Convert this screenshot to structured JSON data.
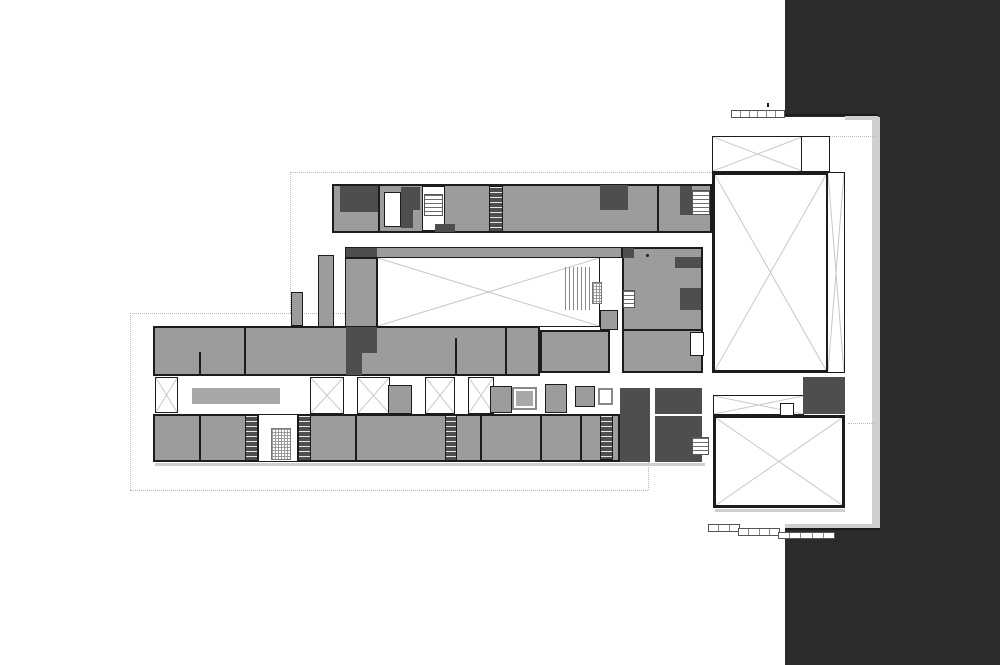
{
  "document": {
    "type": "architectural-floor-plan",
    "visible_text": [],
    "notes": "monochrome building floor plan; no text labels visible"
  },
  "plan": {
    "colors": {
      "background": "#ffffff",
      "dark-mass": "#2b2b2b",
      "room-fill": "#9c9c9c",
      "core-fill": "#4e4e4e",
      "wall": "#1c1c1c",
      "xline": "#c8c8c8",
      "dotted": "#b9b9b9",
      "shadow": "#cfcfcf",
      "furniture": "#a8a8a8",
      "white-fill": "#ffffff",
      "window-border": "#8a8a8a"
    },
    "elements": [
      {
        "n": "site-dark-mass-top",
        "t": "dark",
        "x": 785,
        "y": 0,
        "w": 215,
        "h": 117
      },
      {
        "n": "site-dark-mass-right",
        "t": "dark",
        "x": 880,
        "y": 117,
        "w": 120,
        "h": 413
      },
      {
        "n": "site-dark-mass-bottom",
        "t": "dark",
        "x": 785,
        "y": 530,
        "w": 215,
        "h": 135
      },
      {
        "n": "dark-edge-shadow-vertical",
        "t": "shadow",
        "x": 872,
        "y": 117,
        "w": 8,
        "h": 407
      },
      {
        "n": "dark-edge-shadow-horizontal",
        "t": "shadow",
        "x": 785,
        "y": 524,
        "w": 95,
        "h": 6
      },
      {
        "n": "dark-edge-line-top",
        "t": "wall",
        "x": 785,
        "y": 114,
        "w": 93,
        "h": 2
      },
      {
        "n": "dark-edge-canopy",
        "t": "shadow",
        "x": 845,
        "y": 116,
        "w": 33,
        "h": 4
      },
      {
        "n": "dark-edge-line-bottom",
        "t": "wall",
        "x": 785,
        "y": 528,
        "w": 95,
        "h": 2
      },
      {
        "n": "site-boundary-top",
        "t": "dotted-h",
        "x": 290,
        "y": 172,
        "w": 422,
        "h": 0
      },
      {
        "n": "site-boundary-left-upper",
        "t": "dotted-v",
        "x": 290,
        "y": 172,
        "w": 0,
        "h": 141
      },
      {
        "n": "site-boundary-step",
        "t": "dotted-h",
        "x": 130,
        "y": 313,
        "w": 215,
        "h": 0
      },
      {
        "n": "site-boundary-left-lower",
        "t": "dotted-v",
        "x": 130,
        "y": 313,
        "w": 0,
        "h": 177
      },
      {
        "n": "site-boundary-bottom",
        "t": "dotted-h",
        "x": 130,
        "y": 490,
        "w": 518,
        "h": 0
      },
      {
        "n": "site-boundary-right-stub",
        "t": "dotted-v",
        "x": 648,
        "y": 462,
        "w": 0,
        "h": 28
      },
      {
        "n": "site-boundary-annex",
        "t": "dotted-h",
        "x": 830,
        "y": 136,
        "w": 47,
        "h": 0
      },
      {
        "n": "site-boundary-annex-lower",
        "t": "dotted-h",
        "x": 848,
        "y": 423,
        "w": 28,
        "h": 0
      },
      {
        "n": "lower-wing-upper-rooms",
        "t": "band",
        "x": 153,
        "y": 326,
        "w": 387,
        "h": 50
      },
      {
        "n": "lower-wing-lower-rooms",
        "t": "band",
        "x": 153,
        "y": 414,
        "w": 467,
        "h": 48
      },
      {
        "n": "lower-wing-bottom-shadow",
        "t": "shadow",
        "x": 155,
        "y": 463,
        "w": 550,
        "h": 3
      },
      {
        "n": "courtyard-gallery-top",
        "t": "room",
        "x": 345,
        "y": 247,
        "w": 277,
        "h": 11
      },
      {
        "n": "gallery-core-cells",
        "t": "core",
        "x": 346,
        "y": 248,
        "w": 31,
        "h": 9
      },
      {
        "n": "courtyard-gallery-left",
        "t": "room",
        "x": 345,
        "y": 258,
        "w": 32,
        "h": 69
      },
      {
        "n": "courtyard-void",
        "t": "void-x",
        "x": 377,
        "y": 257,
        "w": 223,
        "h": 70
      },
      {
        "n": "courtyard-stair",
        "t": "stair-v",
        "x": 565,
        "y": 267,
        "w": 28,
        "h": 43
      },
      {
        "n": "courtyard-elevator",
        "t": "stair-fine",
        "x": 592,
        "y": 282,
        "w": 10,
        "h": 22
      },
      {
        "n": "courtyard-east-walk",
        "t": "room",
        "x": 600,
        "y": 310,
        "w": 18,
        "h": 20
      },
      {
        "n": "west-link-corridor",
        "t": "room",
        "x": 318,
        "y": 255,
        "w": 16,
        "h": 72
      },
      {
        "n": "west-link-stub",
        "t": "room",
        "x": 291,
        "y": 292,
        "w": 12,
        "h": 34
      },
      {
        "n": "top-wing",
        "t": "band",
        "x": 332,
        "y": 184,
        "w": 380,
        "h": 49
      },
      {
        "n": "top-wing-core-a",
        "t": "core",
        "x": 340,
        "y": 186,
        "w": 38,
        "h": 26
      },
      {
        "n": "top-wing-room-divider-a",
        "t": "wall",
        "x": 378,
        "y": 184,
        "w": 2,
        "h": 49
      },
      {
        "n": "top-wing-white-room",
        "t": "white-room",
        "x": 384,
        "y": 192,
        "w": 17,
        "h": 35
      },
      {
        "n": "top-wing-core-b",
        "t": "core",
        "x": 401,
        "y": 187,
        "w": 19,
        "h": 23
      },
      {
        "n": "top-wing-core-b2",
        "t": "core",
        "x": 401,
        "y": 210,
        "w": 12,
        "h": 18
      },
      {
        "n": "top-wing-stair-bay",
        "t": "white-room",
        "x": 422,
        "y": 186,
        "w": 23,
        "h": 45
      },
      {
        "n": "top-wing-stair",
        "t": "stair-h",
        "x": 424,
        "y": 194,
        "w": 19,
        "h": 22
      },
      {
        "n": "top-wing-core-c",
        "t": "core",
        "x": 435,
        "y": 224,
        "w": 20,
        "h": 8
      },
      {
        "n": "top-wing-stair-core",
        "t": "core-stair",
        "x": 489,
        "y": 186,
        "w": 14,
        "h": 46
      },
      {
        "n": "top-wing-core-d",
        "t": "core",
        "x": 600,
        "y": 185,
        "w": 28,
        "h": 25
      },
      {
        "n": "top-wing-room-divider-b",
        "t": "wall",
        "x": 657,
        "y": 184,
        "w": 2,
        "h": 49
      },
      {
        "n": "top-wing-core-e",
        "t": "core",
        "x": 680,
        "y": 186,
        "w": 12,
        "h": 29
      },
      {
        "n": "top-wing-stair-east",
        "t": "stair-h",
        "x": 692,
        "y": 190,
        "w": 18,
        "h": 25
      },
      {
        "n": "mid-east-block",
        "t": "band",
        "x": 622,
        "y": 247,
        "w": 81,
        "h": 126
      },
      {
        "n": "mid-east-core-a",
        "t": "core",
        "x": 623,
        "y": 248,
        "w": 11,
        "h": 10
      },
      {
        "n": "mid-east-core-b",
        "t": "core",
        "x": 675,
        "y": 257,
        "w": 26,
        "h": 11
      },
      {
        "n": "mid-east-core-wedges",
        "t": "core",
        "x": 680,
        "y": 288,
        "w": 21,
        "h": 22
      },
      {
        "n": "mid-east-stair",
        "t": "stair-h",
        "x": 623,
        "y": 290,
        "w": 12,
        "h": 18
      },
      {
        "n": "mid-east-wall",
        "t": "wall",
        "x": 622,
        "y": 329,
        "w": 81,
        "h": 2
      },
      {
        "n": "mid-east-white-cells",
        "t": "white-room",
        "x": 690,
        "y": 332,
        "w": 14,
        "h": 24
      },
      {
        "n": "mid-east-column-dot",
        "t": "dot",
        "x": 646,
        "y": 254,
        "w": 3,
        "h": 3
      },
      {
        "n": "mid-center-block",
        "t": "band",
        "x": 540,
        "y": 330,
        "w": 70,
        "h": 43
      },
      {
        "n": "upper-rooms-divider-a",
        "t": "wall",
        "x": 199,
        "y": 352,
        "w": 2,
        "h": 24
      },
      {
        "n": "upper-rooms-divider-b",
        "t": "wall",
        "x": 244,
        "y": 326,
        "w": 2,
        "h": 50
      },
      {
        "n": "upper-rooms-divider-c",
        "t": "wall",
        "x": 455,
        "y": 338,
        "w": 2,
        "h": 38
      },
      {
        "n": "upper-rooms-divider-d",
        "t": "wall",
        "x": 505,
        "y": 326,
        "w": 2,
        "h": 50
      },
      {
        "n": "core-cells-west-gallery",
        "t": "core",
        "x": 346,
        "y": 327,
        "w": 31,
        "h": 26
      },
      {
        "n": "core-cells-west-gallery-2",
        "t": "core",
        "x": 346,
        "y": 353,
        "w": 16,
        "h": 22
      },
      {
        "n": "lightwell-bay-1",
        "t": "void-x",
        "x": 155,
        "y": 377,
        "w": 23,
        "h": 36
      },
      {
        "n": "corridor-furniture",
        "t": "furniture",
        "x": 192,
        "y": 388,
        "w": 88,
        "h": 16
      },
      {
        "n": "lightwell-bay-2",
        "t": "void-x",
        "x": 310,
        "y": 377,
        "w": 34,
        "h": 37
      },
      {
        "n": "lightwell-bay-3",
        "t": "void-x",
        "x": 357,
        "y": 377,
        "w": 33,
        "h": 37
      },
      {
        "n": "lightwell-block-1",
        "t": "room",
        "x": 388,
        "y": 385,
        "w": 24,
        "h": 29
      },
      {
        "n": "lightwell-bay-4",
        "t": "void-x",
        "x": 425,
        "y": 377,
        "w": 30,
        "h": 37
      },
      {
        "n": "lightwell-bay-5",
        "t": "void-x",
        "x": 468,
        "y": 377,
        "w": 26,
        "h": 37
      },
      {
        "n": "lightwell-block-2",
        "t": "room",
        "x": 490,
        "y": 386,
        "w": 22,
        "h": 27
      },
      {
        "n": "corridor-window-box",
        "t": "window-box",
        "x": 512,
        "y": 387,
        "w": 25,
        "h": 23
      },
      {
        "n": "corridor-window-inset",
        "t": "furniture",
        "x": 516,
        "y": 391,
        "w": 17,
        "h": 15
      },
      {
        "n": "lightwell-block-3",
        "t": "room",
        "x": 545,
        "y": 384,
        "w": 22,
        "h": 29
      },
      {
        "n": "lightwell-block-4",
        "t": "room",
        "x": 575,
        "y": 386,
        "w": 20,
        "h": 21
      },
      {
        "n": "corridor-white-box",
        "t": "window-box",
        "x": 598,
        "y": 388,
        "w": 15,
        "h": 17
      },
      {
        "n": "stair-core-a",
        "t": "core-stair",
        "x": 245,
        "y": 415,
        "w": 13,
        "h": 46
      },
      {
        "n": "central-stair-bay",
        "t": "white-room",
        "x": 258,
        "y": 414,
        "w": 40,
        "h": 48
      },
      {
        "n": "central-stair",
        "t": "stair-fine",
        "x": 271,
        "y": 428,
        "w": 20,
        "h": 32
      },
      {
        "n": "stair-core-b",
        "t": "core-stair",
        "x": 298,
        "y": 415,
        "w": 13,
        "h": 46
      },
      {
        "n": "stair-core-c",
        "t": "core-stair",
        "x": 445,
        "y": 415,
        "w": 12,
        "h": 46
      },
      {
        "n": "stair-core-d",
        "t": "core-stair",
        "x": 600,
        "y": 415,
        "w": 13,
        "h": 45
      },
      {
        "n": "lower-rooms-divider-a",
        "t": "wall",
        "x": 199,
        "y": 414,
        "w": 2,
        "h": 48
      },
      {
        "n": "lower-rooms-divider-b",
        "t": "wall",
        "x": 355,
        "y": 414,
        "w": 2,
        "h": 48
      },
      {
        "n": "lower-rooms-divider-c",
        "t": "wall",
        "x": 480,
        "y": 414,
        "w": 2,
        "h": 48
      },
      {
        "n": "lower-rooms-divider-d",
        "t": "wall",
        "x": 540,
        "y": 414,
        "w": 2,
        "h": 48
      },
      {
        "n": "lower-rooms-divider-e",
        "t": "wall",
        "x": 580,
        "y": 414,
        "w": 2,
        "h": 48
      },
      {
        "n": "entry-door-line",
        "t": "wall",
        "x": 168,
        "y": 460,
        "w": 37,
        "h": 2
      },
      {
        "n": "east-core-block-1",
        "t": "core",
        "x": 620,
        "y": 388,
        "w": 30,
        "h": 74
      },
      {
        "n": "east-core-block-2a",
        "t": "core",
        "x": 655,
        "y": 388,
        "w": 47,
        "h": 26
      },
      {
        "n": "east-core-block-2b",
        "t": "core",
        "x": 655,
        "y": 416,
        "w": 47,
        "h": 46
      },
      {
        "n": "east-stair",
        "t": "stair-h",
        "x": 692,
        "y": 437,
        "w": 17,
        "h": 18
      },
      {
        "n": "annex-entry-box",
        "t": "void-x",
        "x": 712,
        "y": 136,
        "w": 91,
        "h": 36
      },
      {
        "n": "annex-entry-box-side",
        "t": "white-room",
        "x": 801,
        "y": 136,
        "w": 29,
        "h": 36
      },
      {
        "n": "annex-hall",
        "t": "void-x thick",
        "x": 712,
        "y": 172,
        "w": 117,
        "h": 201
      },
      {
        "n": "annex-hall-strip",
        "t": "void-x",
        "x": 827,
        "y": 172,
        "w": 18,
        "h": 201
      },
      {
        "n": "annex-link-strip",
        "t": "void-x",
        "x": 713,
        "y": 395,
        "w": 91,
        "h": 20
      },
      {
        "n": "annex-link-notch",
        "t": "white-room",
        "x": 780,
        "y": 403,
        "w": 14,
        "h": 13
      },
      {
        "n": "annex-core",
        "t": "core",
        "x": 803,
        "y": 377,
        "w": 42,
        "h": 37
      },
      {
        "n": "annex-lower-hall",
        "t": "void-x thick",
        "x": 713,
        "y": 415,
        "w": 132,
        "h": 93
      },
      {
        "n": "annex-lower-shadow",
        "t": "shadow",
        "x": 715,
        "y": 509,
        "w": 130,
        "h": 3
      },
      {
        "n": "scale-bar-top",
        "t": "bar",
        "x": 731,
        "y": 110,
        "w": 54,
        "h": 8,
        "segs": 6
      },
      {
        "n": "scale-bar-top-tick",
        "t": "wall",
        "x": 767,
        "y": 103,
        "w": 2,
        "h": 4
      },
      {
        "n": "scale-bar-bottom-1",
        "t": "bar",
        "x": 708,
        "y": 524,
        "w": 32,
        "h": 8,
        "segs": 3
      },
      {
        "n": "scale-bar-bottom-2",
        "t": "bar",
        "x": 738,
        "y": 528,
        "w": 42,
        "h": 8,
        "segs": 4
      },
      {
        "n": "scale-bar-bottom-3",
        "t": "bar",
        "x": 778,
        "y": 532,
        "w": 57,
        "h": 7,
        "segs": 5
      }
    ]
  }
}
